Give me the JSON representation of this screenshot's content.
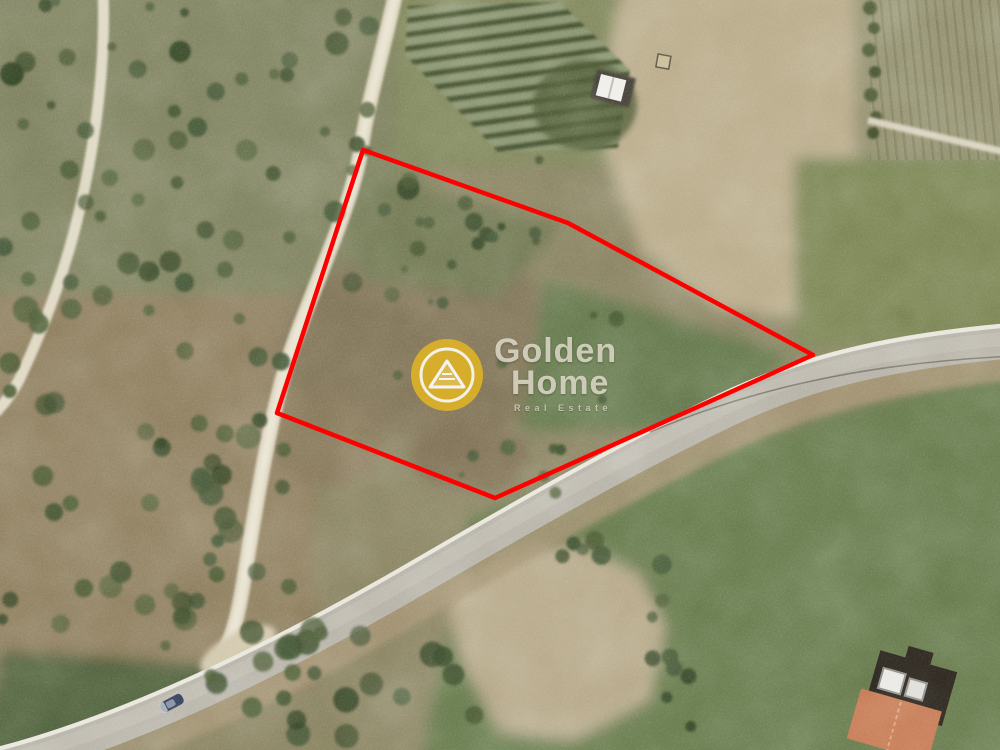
{
  "watermark": {
    "brand_line1": "Golden",
    "brand_line2": "Home",
    "tagline": "Real Estate",
    "colors": {
      "circle": "#e2b424",
      "ring": "#ffffff",
      "text": "#e9e3d3"
    }
  },
  "boundary": {
    "color": "#ff0000",
    "stroke_width": 4.5,
    "points": "363,150 568,223 813,355 495,498 277,413"
  },
  "scene": {
    "type": "satellite-aerial-photo",
    "landmarks": [
      "asphalt-road",
      "dirt-road",
      "footpath",
      "olive-grove",
      "vineyard-rows",
      "bare-tan-field",
      "plowed-patch",
      "white-shed",
      "farm-building-terracotta-roof",
      "car-on-road"
    ],
    "colors": {
      "asphalt": "#b4b0a5",
      "road_edge_line": "#e8e5da",
      "dirt_road": "#dcd4be",
      "tan_field": "#b7a987",
      "green_field": "#647749",
      "olive_ground": "#8c7c5c",
      "tree": "#3a4c2a",
      "terracotta_roof": "#c3754e",
      "car": "#2e3b55"
    }
  }
}
